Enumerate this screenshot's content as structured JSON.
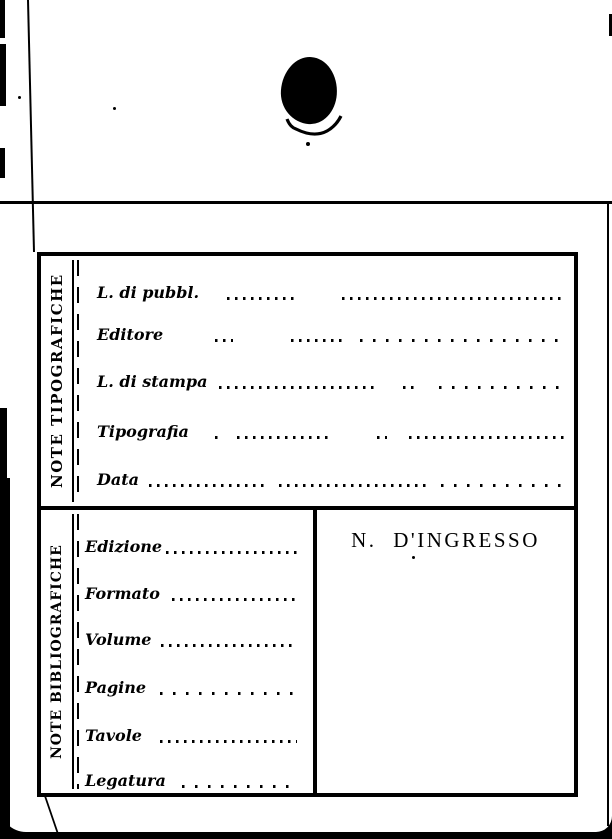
{
  "colors": {
    "ink": "#000000",
    "paper": "#ffffff"
  },
  "card": {
    "sections": [
      {
        "side_label": "NOTE TIPOGRAFICHE",
        "fields": [
          {
            "label": "L. di pubbl.",
            "value": ""
          },
          {
            "label": "Editore",
            "value": ""
          },
          {
            "label": "L. di stampa",
            "value": ""
          },
          {
            "label": "Tipografia",
            "value": ""
          },
          {
            "label": "Data",
            "value": ""
          }
        ]
      },
      {
        "side_label": "NOTE BIBLIOGRAFICHE",
        "fields": [
          {
            "label": "Edizione",
            "value": ""
          },
          {
            "label": "Formato",
            "value": ""
          },
          {
            "label": "Volume",
            "value": ""
          },
          {
            "label": "Pagine",
            "value": ""
          },
          {
            "label": "Tavole",
            "value": ""
          },
          {
            "label": "Legatura",
            "value": ""
          }
        ],
        "right_box": {
          "label": "N. D'INGRESSO"
        }
      }
    ]
  }
}
